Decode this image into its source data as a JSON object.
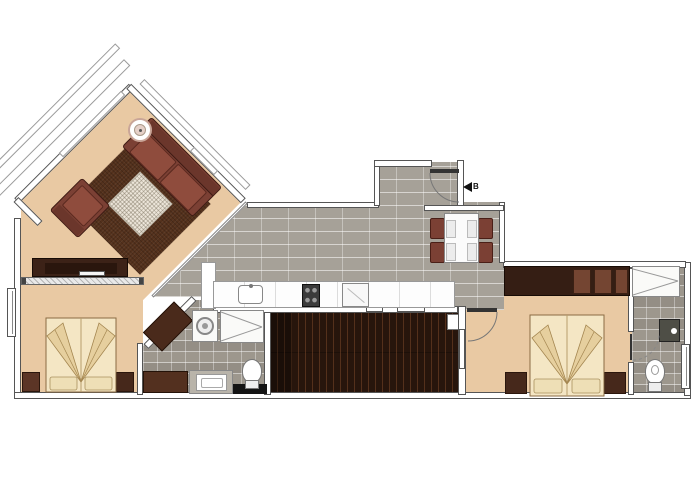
{
  "title": "apartment-floor-plan",
  "entrance_marker": {
    "icon": "left-arrow-icon",
    "label": "B"
  },
  "colors": {
    "paper": "#ffffff",
    "wall_outline": "#555555",
    "floor_tan": "#e9c9a3",
    "tile_gray": "#a6a198",
    "tile_bath": "#9d978d",
    "deck_brown": "#27150c",
    "rug_brown": "#54311c",
    "rug_inlay": "#ece5d9",
    "upholstery": "#7b4034",
    "wood_dark": "#3c2217",
    "bed_cream": "#f4e6c4",
    "marker_black": "#111111"
  },
  "legend": {
    "rooms": [
      "living-room",
      "hall-corridor",
      "entrance-lobby",
      "dining-area",
      "kitchen",
      "bedroom-1",
      "bathroom-1",
      "deck",
      "bedroom-2",
      "bathroom-2",
      "balcony"
    ],
    "furniture": [
      "sofa",
      "armchair",
      "rug",
      "side-table",
      "tv-console",
      "double-bed",
      "nightstand",
      "wardrobe",
      "dining-table",
      "dining-chair",
      "kitchen-counter",
      "sink",
      "cooktop",
      "oven",
      "washing-machine",
      "shower",
      "toilet",
      "washbasin"
    ]
  }
}
